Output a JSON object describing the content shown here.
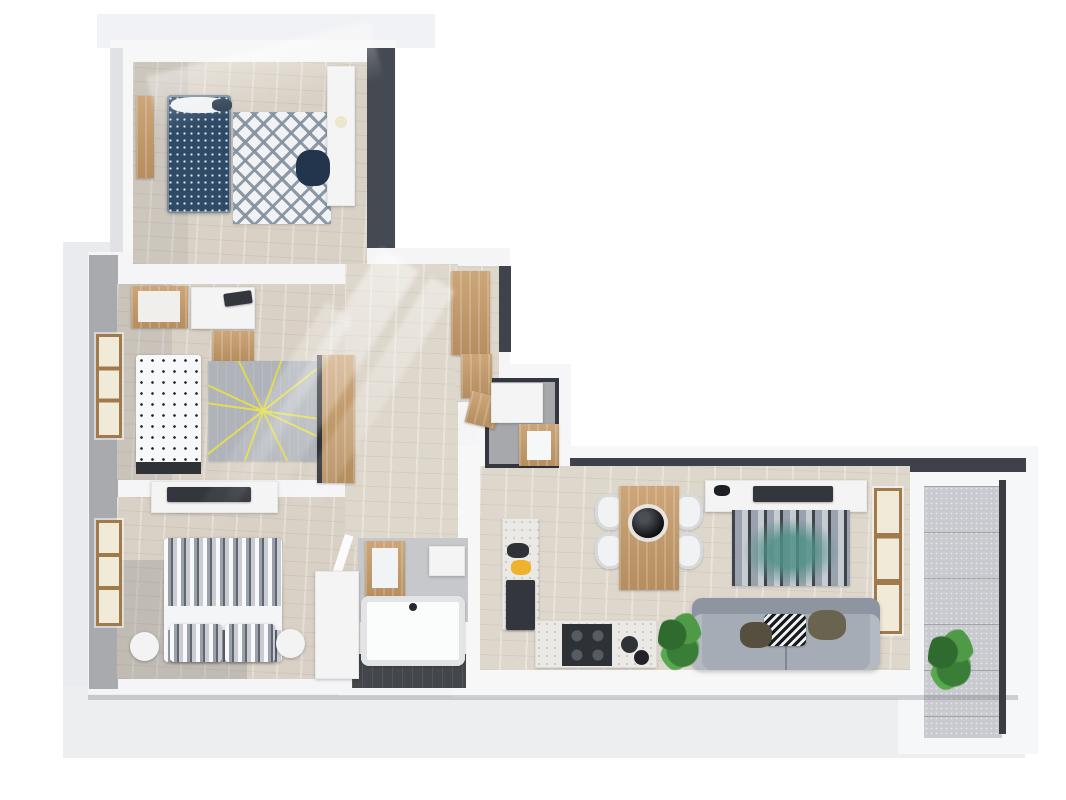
{
  "meta": {
    "title": "3D apartment floor plan",
    "description": "3D rendered top-down floor plan of a three-bedroom apartment with a blue single-bed room, a children's room, a master bedroom, hallway with wardrobes, bathroom with tub, separate WC, open kitchen-dining-living area and a balcony with plants"
  },
  "palette": {
    "background": "#ffffff",
    "base_plate": "#eceef0",
    "wall_white": "#f6f6f8",
    "wall_dark": "#454952",
    "exterior_wall_gray": "#a8aaae",
    "wood_floor": "#d9d1c5",
    "wood_furniture": "#c59a67",
    "bed_blue": "#2e4a66",
    "rug_yellow_accent": "#e3dc52",
    "rug_teal_accent": "#4f8f86",
    "sofa_gray": "#a6acb5",
    "dark_tile_floor": "#43464b",
    "plant_green": "#4e9a46",
    "fruit_bowl_yellow": "#efb22d"
  },
  "scene": {
    "width": 1066,
    "height": 800,
    "elements": [
      {
        "name": "base-plate-top",
        "kind": "box",
        "x": 97,
        "y": 14,
        "w": 338,
        "h": 34,
        "c": "#f1f2f5"
      },
      {
        "name": "base-plate-left",
        "kind": "box",
        "x": 63,
        "y": 242,
        "w": 52,
        "h": 450,
        "c": "#e9ebee"
      },
      {
        "name": "base-plate-bottom",
        "kind": "box",
        "x": 63,
        "y": 686,
        "w": 962,
        "h": 72,
        "c": "#eceef0"
      },
      {
        "name": "bedroom1-walls",
        "kind": "box",
        "x": 110,
        "y": 40,
        "w": 286,
        "h": 232,
        "c": "#f7f7f8"
      },
      {
        "name": "bedroom1-wall-shade-left",
        "kind": "box",
        "x": 110,
        "y": 48,
        "w": 13,
        "h": 222,
        "c": "#e1e2e5"
      },
      {
        "name": "bedroom1-wall-dark-right",
        "kind": "box",
        "x": 367,
        "y": 48,
        "w": 28,
        "h": 224,
        "c": "#454952"
      },
      {
        "name": "left-block-walls",
        "kind": "box",
        "x": 88,
        "y": 252,
        "w": 332,
        "h": 442,
        "c": "#f5f5f7"
      },
      {
        "name": "exterior-wall-gray-left",
        "kind": "box",
        "x": 89,
        "y": 255,
        "w": 29,
        "h": 434,
        "c": "#a8aaae"
      },
      {
        "name": "hallway-walls",
        "kind": "box",
        "x": 340,
        "y": 248,
        "w": 170,
        "h": 302,
        "c": "#f5f5f7"
      },
      {
        "name": "hallway-wall-dark-edge",
        "kind": "box",
        "x": 499,
        "y": 266,
        "w": 12,
        "h": 86,
        "c": "#3f434b"
      },
      {
        "name": "wc-walls",
        "kind": "box",
        "x": 477,
        "y": 364,
        "w": 94,
        "h": 112,
        "c": "#f6f6f8"
      },
      {
        "name": "bathroom-walls",
        "kind": "box",
        "x": 338,
        "y": 526,
        "w": 142,
        "h": 170,
        "c": "#f5f5f7"
      },
      {
        "name": "living-wing-walls",
        "kind": "box",
        "x": 453,
        "y": 446,
        "w": 584,
        "h": 252,
        "c": "#f7f7f8"
      },
      {
        "name": "balcony-walls",
        "kind": "box",
        "x": 898,
        "y": 446,
        "w": 140,
        "h": 308,
        "c": "#f6f7f8"
      },
      {
        "name": "living-wall-dark-top",
        "kind": "box",
        "x": 570,
        "y": 458,
        "w": 456,
        "h": 14,
        "c": "#3e414a"
      },
      {
        "name": "bedroom1-floor",
        "kind": "wood-floor",
        "x": 133,
        "y": 62,
        "w": 234,
        "h": 202
      },
      {
        "name": "bedroom2-floor",
        "kind": "wood-floor",
        "x": 117,
        "y": 284,
        "w": 231,
        "h": 196
      },
      {
        "name": "bedroom3-floor",
        "kind": "wood-floor",
        "x": 117,
        "y": 497,
        "w": 243,
        "h": 182
      },
      {
        "name": "hallway-floor",
        "kind": "wood-floor-light",
        "x": 345,
        "y": 264,
        "w": 113,
        "h": 282
      },
      {
        "name": "entry-floor",
        "kind": "wood-floor-light",
        "x": 455,
        "y": 266,
        "w": 44,
        "h": 136
      },
      {
        "name": "living-kitchen-floor",
        "kind": "wood-floor-light",
        "x": 480,
        "y": 466,
        "w": 430,
        "h": 204
      },
      {
        "name": "wc-floor",
        "kind": "wc-room",
        "x": 485,
        "y": 378,
        "w": 74,
        "h": 90
      },
      {
        "name": "bathroom-upper-area",
        "kind": "box",
        "x": 358,
        "y": 538,
        "w": 110,
        "h": 84,
        "c": "#c6c8cb"
      },
      {
        "name": "bathroom-floor-dark",
        "kind": "dark-floor",
        "x": 352,
        "y": 654,
        "w": 114,
        "h": 34
      },
      {
        "name": "balcony-floor",
        "kind": "concrete-floor",
        "x": 924,
        "y": 486,
        "w": 78,
        "h": 252
      },
      {
        "name": "bedroom3-corner-shadow",
        "kind": "box",
        "x": 117,
        "y": 560,
        "w": 130,
        "h": 119,
        "c": "rgba(120,122,128,0.25)"
      },
      {
        "name": "bedroom2-left-shadow",
        "kind": "box",
        "x": 117,
        "y": 284,
        "w": 55,
        "h": 196,
        "c": "rgba(120,122,128,0.16)"
      },
      {
        "name": "bedroom1-left-shadow",
        "kind": "box",
        "x": 133,
        "y": 62,
        "w": 55,
        "h": 202,
        "c": "rgba(120,122,128,0.13)"
      },
      {
        "name": "bedroom2-window",
        "kind": "window-wood",
        "x": 96,
        "y": 334,
        "w": 26,
        "h": 104
      },
      {
        "name": "bedroom3-window",
        "kind": "window-wood",
        "x": 96,
        "y": 520,
        "w": 26,
        "h": 106
      },
      {
        "name": "bedroom1-door",
        "kind": "wood",
        "x": 136,
        "y": 96,
        "w": 18,
        "h": 82
      },
      {
        "name": "living-window",
        "kind": "window-wood",
        "x": 874,
        "y": 488,
        "w": 28,
        "h": 146
      },
      {
        "name": "bathroom-door-leaf",
        "kind": "box",
        "x": 337,
        "y": 534,
        "w": 9,
        "h": 50,
        "c": "#fbfbfc",
        "r": 18
      },
      {
        "name": "bedroom1-bed",
        "kind": "bed-blue",
        "x": 167,
        "y": 95,
        "w": 64,
        "h": 118
      },
      {
        "name": "bedroom1-pillow",
        "kind": "blob",
        "x": 171,
        "y": 97,
        "w": 56,
        "h": 16,
        "c": "#f1f2f3"
      },
      {
        "name": "bedroom1-bed-tray",
        "kind": "blob",
        "x": 212,
        "y": 99,
        "w": 20,
        "h": 12,
        "c": "#2c3e52"
      },
      {
        "name": "bedroom1-rug",
        "kind": "rug-diamond",
        "x": 233,
        "y": 112,
        "w": 98,
        "h": 112
      },
      {
        "name": "bedroom1-desk",
        "kind": "white-furn",
        "x": 327,
        "y": 66,
        "w": 28,
        "h": 140
      },
      {
        "name": "bedroom1-chair",
        "kind": "blob",
        "x": 296,
        "y": 150,
        "w": 34,
        "h": 36,
        "c": "#22354d"
      },
      {
        "name": "bedroom1-lamp",
        "kind": "circle",
        "x": 335,
        "y": 116,
        "w": 12,
        "h": 12,
        "c": "#ece6cc"
      },
      {
        "name": "bedroom2-crib",
        "kind": "wood",
        "x": 131,
        "y": 286,
        "w": 57,
        "h": 42
      },
      {
        "name": "bedroom2-crib-mattress",
        "kind": "box",
        "x": 138,
        "y": 291,
        "w": 42,
        "h": 31,
        "c": "#f1efec"
      },
      {
        "name": "bedroom2-desk",
        "kind": "white-furn",
        "x": 191,
        "y": 287,
        "w": 64,
        "h": 42
      },
      {
        "name": "bedroom2-laptop",
        "kind": "dark-furn",
        "x": 224,
        "y": 292,
        "w": 28,
        "h": 13,
        "r": -8
      },
      {
        "name": "bedroom2-chair",
        "kind": "wood",
        "x": 212,
        "y": 331,
        "w": 42,
        "h": 30
      },
      {
        "name": "bedroom2-bed",
        "kind": "bed-letters",
        "x": 136,
        "y": 355,
        "w": 65,
        "h": 112
      },
      {
        "name": "bedroom2-bed-footboard",
        "kind": "box",
        "x": 136,
        "y": 462,
        "w": 65,
        "h": 12,
        "c": "#2f3237"
      },
      {
        "name": "bedroom2-rug",
        "kind": "rug-lines",
        "x": 208,
        "y": 361,
        "w": 110,
        "h": 100
      },
      {
        "name": "bedroom2-wardrobe",
        "kind": "wood dark-edge",
        "x": 317,
        "y": 355,
        "w": 38,
        "h": 128
      },
      {
        "name": "bedroom3-dresser",
        "kind": "white-furn",
        "x": 151,
        "y": 481,
        "w": 127,
        "h": 32
      },
      {
        "name": "bedroom3-tv",
        "kind": "dark-furn",
        "x": 167,
        "y": 487,
        "w": 84,
        "h": 15
      },
      {
        "name": "bedroom3-bed",
        "kind": "bed-stripes",
        "x": 164,
        "y": 538,
        "w": 118,
        "h": 124
      },
      {
        "name": "bedroom3-bed-sheet",
        "kind": "box",
        "x": 164,
        "y": 606,
        "w": 118,
        "h": 24,
        "c": "#f4f5f6"
      },
      {
        "name": "bedroom3-pillow-left",
        "kind": "bed-stripes",
        "x": 170,
        "y": 624,
        "w": 52,
        "h": 38
      },
      {
        "name": "bedroom3-pillow-right",
        "kind": "bed-stripes",
        "x": 225,
        "y": 624,
        "w": 50,
        "h": 38
      },
      {
        "name": "bedroom3-nightstand-left",
        "kind": "round-white",
        "x": 130,
        "y": 632,
        "w": 29,
        "h": 29
      },
      {
        "name": "bedroom3-nightstand-right",
        "kind": "round-white",
        "x": 276,
        "y": 629,
        "w": 29,
        "h": 29
      },
      {
        "name": "bedroom3-wardrobe",
        "kind": "white-furn dark-edge",
        "x": 315,
        "y": 571,
        "w": 44,
        "h": 108
      },
      {
        "name": "entry-cabinet-upper",
        "kind": "wood",
        "x": 451,
        "y": 271,
        "w": 39,
        "h": 84
      },
      {
        "name": "entry-cabinet-middle",
        "kind": "wood",
        "x": 461,
        "y": 354,
        "w": 31,
        "h": 44
      },
      {
        "name": "entry-cabinet-lower",
        "kind": "wood",
        "x": 468,
        "y": 394,
        "w": 31,
        "h": 32,
        "r": 14
      },
      {
        "name": "wc-shower",
        "kind": "white-furn",
        "x": 491,
        "y": 383,
        "w": 52,
        "h": 40
      },
      {
        "name": "wc-vanity",
        "kind": "wood",
        "x": 519,
        "y": 424,
        "w": 40,
        "h": 42
      },
      {
        "name": "wc-sink",
        "kind": "box",
        "x": 527,
        "y": 431,
        "w": 24,
        "h": 29,
        "c": "#f6f7f8"
      },
      {
        "name": "bathroom-mirror-cabinet",
        "kind": "wood",
        "x": 365,
        "y": 541,
        "w": 40,
        "h": 60
      },
      {
        "name": "bathroom-mirror",
        "kind": "box",
        "x": 372,
        "y": 548,
        "w": 26,
        "h": 40,
        "c": "#f2f3f4"
      },
      {
        "name": "bathroom-shelf",
        "kind": "white-furn",
        "x": 429,
        "y": 546,
        "w": 36,
        "h": 30
      },
      {
        "name": "bathroom-tub",
        "kind": "tub",
        "x": 361,
        "y": 596,
        "w": 104,
        "h": 70
      },
      {
        "name": "kitchen-counter-vertical",
        "kind": "counter",
        "x": 502,
        "y": 518,
        "w": 37,
        "h": 112
      },
      {
        "name": "kitchen-fridge",
        "kind": "dark-furn",
        "x": 506,
        "y": 580,
        "w": 29,
        "h": 50
      },
      {
        "name": "kitchen-small-appliance",
        "kind": "blob",
        "x": 507,
        "y": 543,
        "w": 22,
        "h": 15,
        "c": "#2e3136"
      },
      {
        "name": "kitchen-fruit-bowl",
        "kind": "blob",
        "x": 511,
        "y": 560,
        "w": 20,
        "h": 15,
        "c": "#efb22d"
      },
      {
        "name": "kitchen-counter-horizontal",
        "kind": "counter",
        "x": 535,
        "y": 620,
        "w": 122,
        "h": 48
      },
      {
        "name": "kitchen-cooktop",
        "kind": "cooktop",
        "x": 562,
        "y": 624,
        "w": 50,
        "h": 42
      },
      {
        "name": "kitchen-pot-large",
        "kind": "circle",
        "x": 621,
        "y": 636,
        "w": 17,
        "h": 17,
        "c": "#2f3237"
      },
      {
        "name": "kitchen-pot-small",
        "kind": "circle",
        "x": 634,
        "y": 650,
        "w": 15,
        "h": 15,
        "c": "#212327"
      },
      {
        "name": "dining-chair-top-left",
        "kind": "chair-white",
        "x": 595,
        "y": 494,
        "w": 30,
        "h": 36
      },
      {
        "name": "dining-chair-bottom-left",
        "kind": "chair-white",
        "x": 595,
        "y": 533,
        "w": 30,
        "h": 36
      },
      {
        "name": "dining-chair-top-right",
        "kind": "chair-white",
        "x": 673,
        "y": 494,
        "w": 30,
        "h": 36
      },
      {
        "name": "dining-chair-bottom-right",
        "kind": "chair-white",
        "x": 673,
        "y": 533,
        "w": 30,
        "h": 36
      },
      {
        "name": "dining-table",
        "kind": "wood",
        "x": 619,
        "y": 486,
        "w": 60,
        "h": 104
      },
      {
        "name": "dining-bowl",
        "kind": "bowl-dark",
        "x": 632,
        "y": 508,
        "w": 32,
        "h": 30
      },
      {
        "name": "living-tv-stand",
        "kind": "white-furn",
        "x": 705,
        "y": 480,
        "w": 162,
        "h": 32
      },
      {
        "name": "living-tv",
        "kind": "dark-furn",
        "x": 753,
        "y": 486,
        "w": 80,
        "h": 16
      },
      {
        "name": "living-media-item",
        "kind": "blob",
        "x": 714,
        "y": 485,
        "w": 16,
        "h": 11,
        "c": "#1d1f23"
      },
      {
        "name": "living-rug",
        "kind": "rug-stripes",
        "x": 732,
        "y": 510,
        "w": 118,
        "h": 76
      },
      {
        "name": "living-sofa",
        "kind": "sofa",
        "x": 692,
        "y": 598,
        "w": 188,
        "h": 72
      },
      {
        "name": "sofa-pillow-zigzag",
        "kind": "zigzag",
        "x": 764,
        "y": 614,
        "w": 42,
        "h": 32
      },
      {
        "name": "sofa-pillow-olive",
        "kind": "blob",
        "x": 808,
        "y": 610,
        "w": 38,
        "h": 30,
        "c": "#6a6350"
      },
      {
        "name": "sofa-pillow-brown",
        "kind": "blob",
        "x": 740,
        "y": 622,
        "w": 32,
        "h": 26,
        "c": "#564f40"
      },
      {
        "name": "living-plant",
        "kind": "plant",
        "x": 658,
        "y": 610,
        "w": 44,
        "h": 62
      },
      {
        "name": "balcony-plant",
        "kind": "plant",
        "x": 928,
        "y": 626,
        "w": 46,
        "h": 66
      },
      {
        "name": "bottom-edge-shadow",
        "kind": "box",
        "x": 88,
        "y": 695,
        "w": 930,
        "h": 5,
        "c": "rgba(100,104,110,0.28)"
      },
      {
        "name": "sunlight-ray-1",
        "kind": "light-ray",
        "x": 296,
        "y": 236,
        "w": 44,
        "h": 310,
        "r": 32,
        "o": 0.5
      },
      {
        "name": "sunlight-ray-2",
        "kind": "light-ray",
        "x": 352,
        "y": 262,
        "w": 28,
        "h": 290,
        "r": 32,
        "o": 0.42
      },
      {
        "name": "sunlight-ray-3",
        "kind": "light-ray",
        "x": 252,
        "y": 290,
        "w": 32,
        "h": 270,
        "r": 32,
        "o": 0.32
      },
      {
        "name": "sunlight-ray-bedroom1",
        "kind": "light-ray",
        "x": 150,
        "y": 48,
        "w": 230,
        "h": 60,
        "r": -14,
        "o": 0.4
      },
      {
        "name": "balcony-railing",
        "kind": "box",
        "x": 999,
        "y": 480,
        "w": 7,
        "h": 254,
        "c": "#3a3d43"
      }
    ]
  }
}
